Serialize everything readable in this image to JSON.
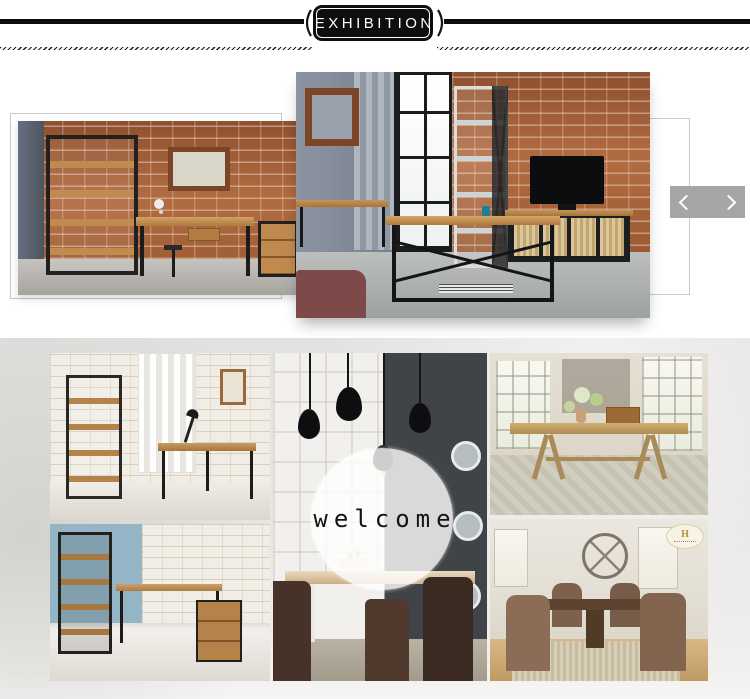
{
  "header": {
    "title": "EXHIBITION",
    "banner_color": "#0e0e0e",
    "rule_color": "#0c0c0c"
  },
  "carousel": {
    "prev_icon": "chevron-left-icon",
    "next_icon": "chevron-right-icon",
    "arrow_box_color": "#a6a6a6",
    "photos": [
      {
        "name": "industrial-study-photo",
        "description": "Industrial bookshelf, writing desk and drawer cabinet against a red brick wall"
      },
      {
        "name": "industrial-living-room-photo",
        "description": "Loft living room with brick wall, tall window, metal shelving, TV cabinet and X-frame coffee table"
      }
    ]
  },
  "gallery": {
    "background_color": "#e7e6e4",
    "welcome_label": "welcome",
    "watermark_letter": "H",
    "photos": [
      {
        "name": "white-brick-office-photo",
        "description": "Black metal bookshelf and industrial desk in a white brick room"
      },
      {
        "name": "blue-wall-office-photo",
        "description": "Desk with wooden file cabinet and shelf against a blue wall"
      },
      {
        "name": "pendant-dining-room-photo",
        "description": "Dining room with black pendant lamps, wood table and dark chairs"
      },
      {
        "name": "farmhouse-table-photo",
        "description": "Rustic trestle dining table with flowers on a gray rug"
      },
      {
        "name": "classic-dining-set-photo",
        "description": "Pedestal dining table with brown tufted chairs and wagon wheel decor"
      }
    ]
  }
}
